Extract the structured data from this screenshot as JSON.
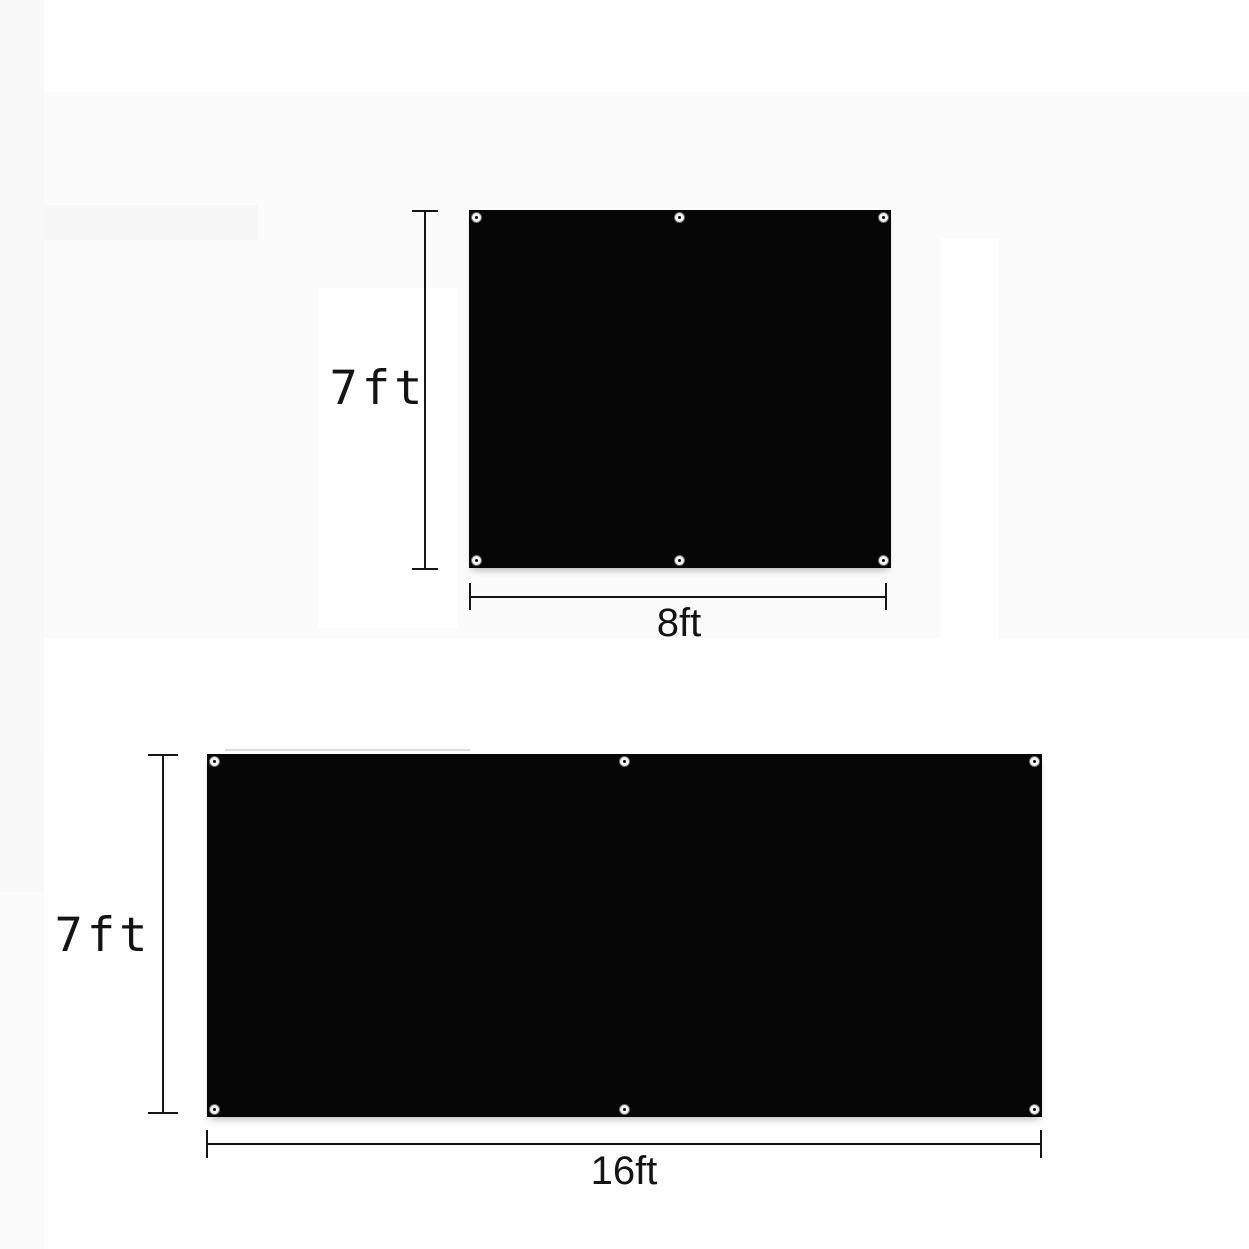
{
  "diagram": {
    "description_visible_text_only": "product dimension diagram with two black grommeted panels",
    "colors": {
      "fabric": "#060606",
      "dimension_line": "#161616",
      "label_text": "#141414",
      "background": "#fbfbfb",
      "grommet_ring": "#f2f2f2"
    },
    "panels": [
      {
        "id": "panel-8x7",
        "height_label": "7ft",
        "width_label": "8ft",
        "grommet_count": 6
      },
      {
        "id": "panel-16x7",
        "height_label": "7ft",
        "width_label": "16ft",
        "grommet_count": 6
      }
    ]
  }
}
